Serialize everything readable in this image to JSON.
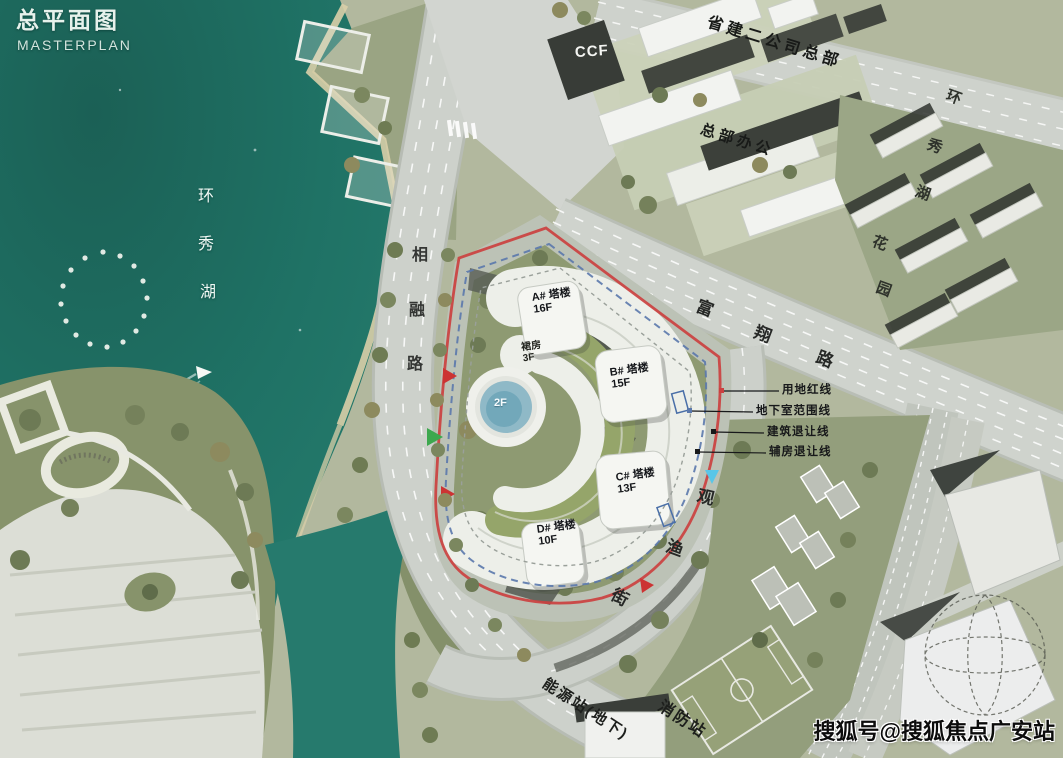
{
  "title": {
    "zh": "总平面图",
    "en": "MASTERPLAN"
  },
  "lake": {
    "name": "环秀湖",
    "chars": [
      "环",
      "秀",
      "湖"
    ]
  },
  "roads": {
    "xiangronglu": {
      "name": "相融路",
      "chars": [
        "相",
        "融",
        "路"
      ]
    },
    "fuxianglu": {
      "name": "富翔路",
      "chars": [
        "富",
        "翔",
        "路"
      ]
    },
    "guanyujie": {
      "name": "观渔街",
      "chars": [
        "观",
        "渔",
        "街"
      ]
    }
  },
  "districts": {
    "residential": {
      "name": "环秀湖花园",
      "chars": [
        "环",
        "秀",
        "湖",
        "花",
        "园"
      ]
    },
    "hq": "省建二公司总部",
    "hq_office": "总部办公",
    "ccf": "CCF"
  },
  "site": {
    "towers": [
      {
        "name": "A# 塔楼",
        "floors": "16F"
      },
      {
        "name": "B# 塔楼",
        "floors": "15F"
      },
      {
        "name": "C# 塔楼",
        "floors": "13F"
      },
      {
        "name": "D# 塔楼",
        "floors": "10F"
      }
    ],
    "podium": {
      "name": "裙房",
      "floors": "3F"
    },
    "pool": {
      "label": "2F"
    },
    "legend": [
      "用地红线",
      "地下室范围线",
      "建筑退让线",
      "辅房退让线"
    ]
  },
  "facilities": {
    "energy": "能源站(地下)",
    "fire": "消防站"
  },
  "watermark": "搜狐号@搜狐焦点广安站",
  "colors": {
    "water": "#1f7265",
    "waterDark": "#175c52",
    "land": "#b2b89e",
    "park": "#87936b",
    "siteGreen": "#8e9a72",
    "road": "#cdd1cb",
    "roof": "#95a56a",
    "red": "#cb4140",
    "blue": "#5a78ac",
    "pool": "#8fb9c7",
    "white": "#eff0eb"
  }
}
